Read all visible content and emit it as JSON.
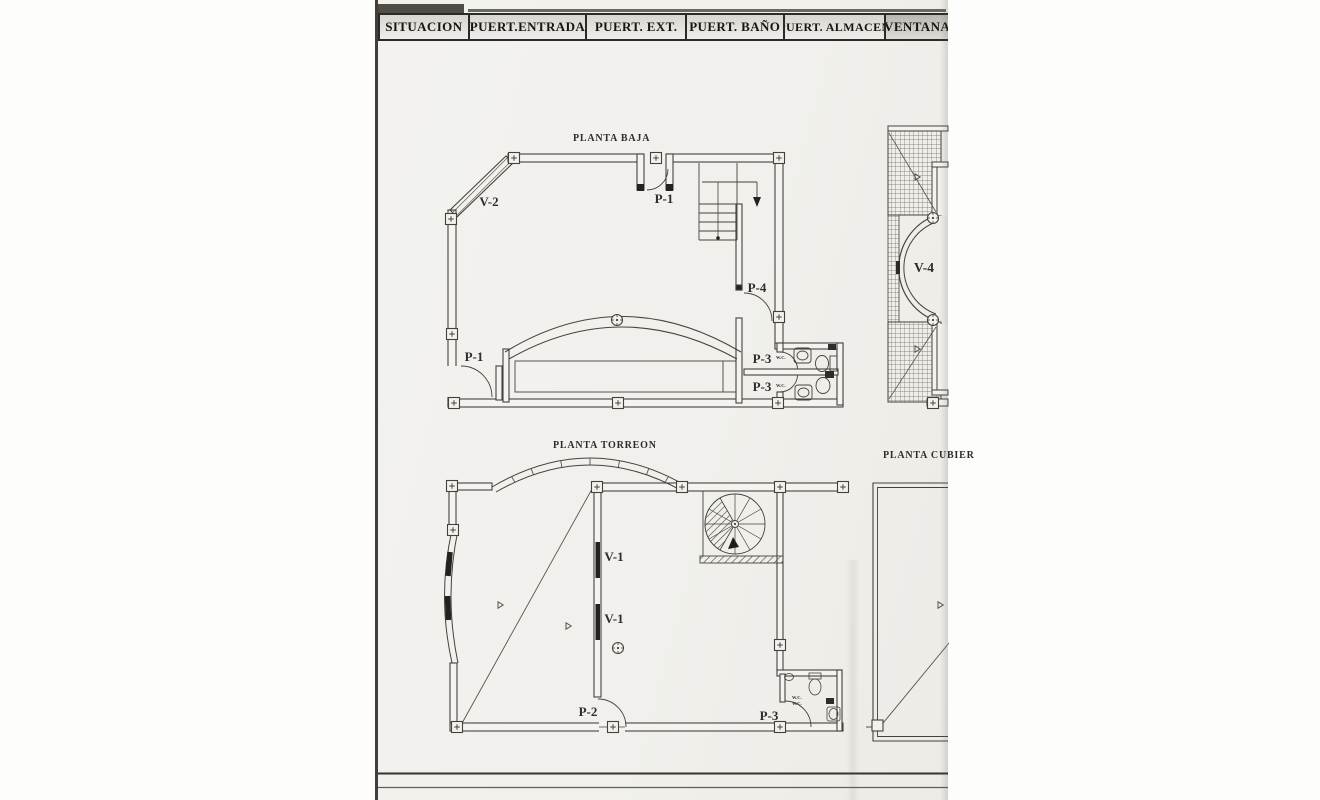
{
  "header": {
    "cells": [
      {
        "label": "SITUACION"
      },
      {
        "label": "PUERT.ENTRADA"
      },
      {
        "label": "PUERT. EXT."
      },
      {
        "label": "PUERT. BAÑO"
      },
      {
        "label": "PUERT. ALMACEN"
      },
      {
        "label": "VENTANA"
      }
    ]
  },
  "plans": {
    "baja": {
      "title": "PLANTA BAJA",
      "labels": {
        "v2": "V-2",
        "p1_top": "P-1",
        "p4": "P-4",
        "p3_upper": "P-3",
        "p3_lower": "P-3",
        "wc_upper": "W.C.",
        "wc_lower": "W.C.",
        "p1_bottom": "P-1"
      }
    },
    "v4": {
      "label": "V-4"
    },
    "torreon": {
      "title": "PLANTA TORREON",
      "labels": {
        "v1_upper": "V-1",
        "v1_lower": "V-1",
        "p2": "P-2",
        "p3": "P-3",
        "wc_line1": "W.C.",
        "wc_line2": "W.C."
      }
    },
    "cubierta": {
      "title": "PLANTA CUBIER"
    }
  },
  "colors": {
    "paper": "#f2f1ee",
    "ink": "#44423d",
    "dark": "#23221f"
  }
}
